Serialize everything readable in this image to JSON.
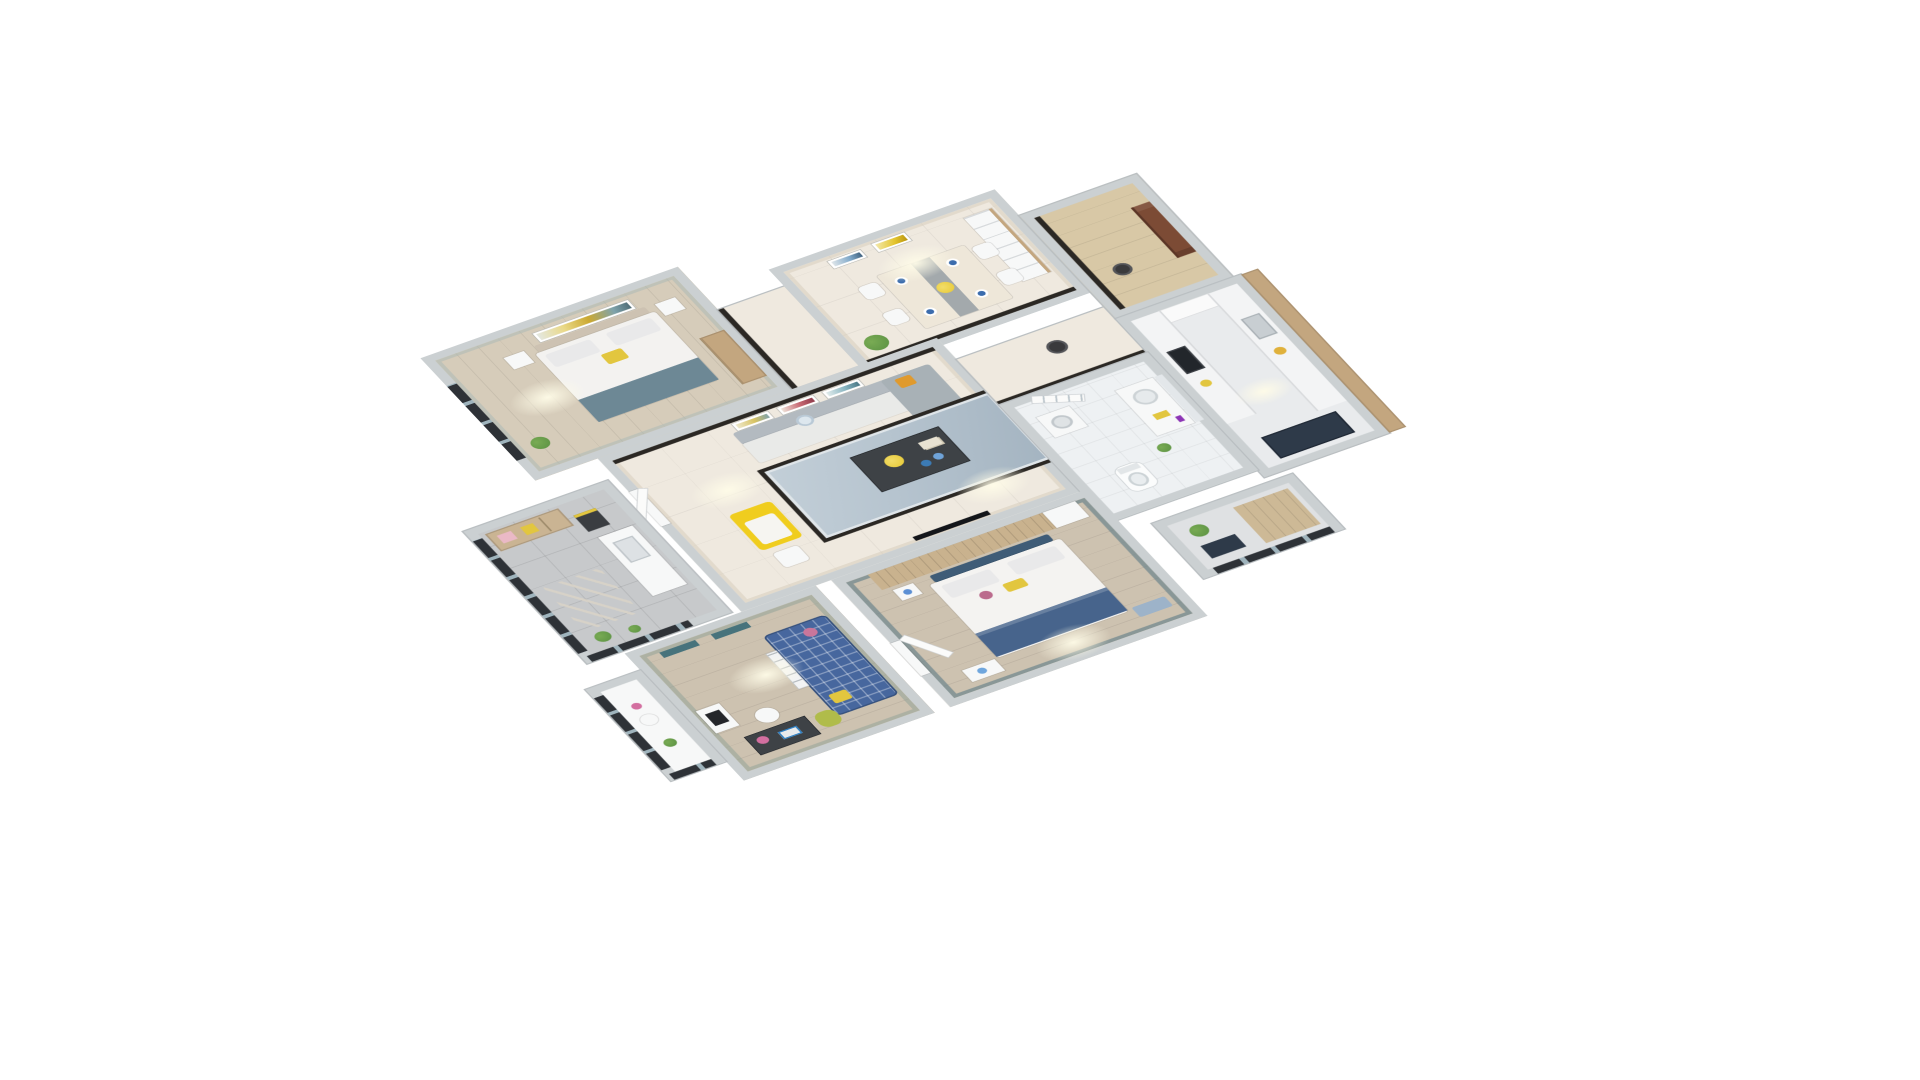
{
  "scene": {
    "type": "isometric-3d-floor-plan-render",
    "style": "dollhouse cutaway viewed from above on plain white background",
    "background": "#ffffff"
  },
  "rooms": {
    "bedroom2": {
      "label": "Second Bedroom"
    },
    "hallN": {
      "label": "Hallway"
    },
    "dining": {
      "label": "Dining Room"
    },
    "living": {
      "label": "Living Room"
    },
    "hallE": {
      "label": "Corridor"
    },
    "entry": {
      "label": "Entryway"
    },
    "kitchen": {
      "label": "Kitchen"
    },
    "bath": {
      "label": "Bathroom"
    },
    "master": {
      "label": "Master Bedroom"
    },
    "kids": {
      "label": "Kids Room Study"
    },
    "utility": {
      "label": "Utility Balcony"
    },
    "kidsBalcony": {
      "label": "Small Balcony"
    },
    "seBalcony": {
      "label": "Service Balcony"
    }
  },
  "colors": {
    "bg": "#ffffff",
    "wall": "#cbd0d2",
    "wallEdge": "#b9bec1",
    "cream": "#efe9df",
    "woodLight": "#d6ccba",
    "woodMid": "#cdc2b0",
    "hallWood": "#d8c8a6",
    "tile": "#c7c9cb",
    "floorKitchen": "#e9ebed",
    "bathFloor": "#eef1f3",
    "balconyFloor": "#dfe1e3",
    "white": "#f7f8f8",
    "rug": "#b6c4cf",
    "marble": "#2b2824",
    "sofaGray": "#b3bac0",
    "cushion": "#e9eae8",
    "chaise": "#a8b1b6",
    "orange": "#e09a2d",
    "starPillow": "#dde7ee",
    "tableDark": "#3e4246",
    "flowersYellow": "#e7c832",
    "bowlBlue": "#3c7bb5",
    "chaiseYellow": "#f0cd1e",
    "diningTable": "#eee7d9",
    "runner": "#a3a9ac",
    "plate": "#3b6cad",
    "chairWhite": "#f5f4f1",
    "woodCab": "#c3a67f",
    "doorBrown": "#7c4b35",
    "doorBrownDark": "#5a3526",
    "navy": "#2e3a49",
    "cooktop": "#22262b",
    "purple": "#8d35b5",
    "tealWall": "#64808a",
    "headboardNavy": "#3f5c77",
    "denim": "#47648c",
    "slatWood": "#c9b28e",
    "plaid": "#47679e",
    "olive": "#b0bc4a",
    "shelfTeal": "#47737c",
    "frameDark": "#2e3237",
    "pink": "#eab9c6",
    "accentYellow": "#e2c63f",
    "throwSlate": "#6d8895",
    "green": "#5a9142",
    "greenLight": "#79ab54",
    "mirror": "#e3e7ea",
    "basket": "#3a3a3c",
    "headboardBeige": "#cdc2b2"
  }
}
